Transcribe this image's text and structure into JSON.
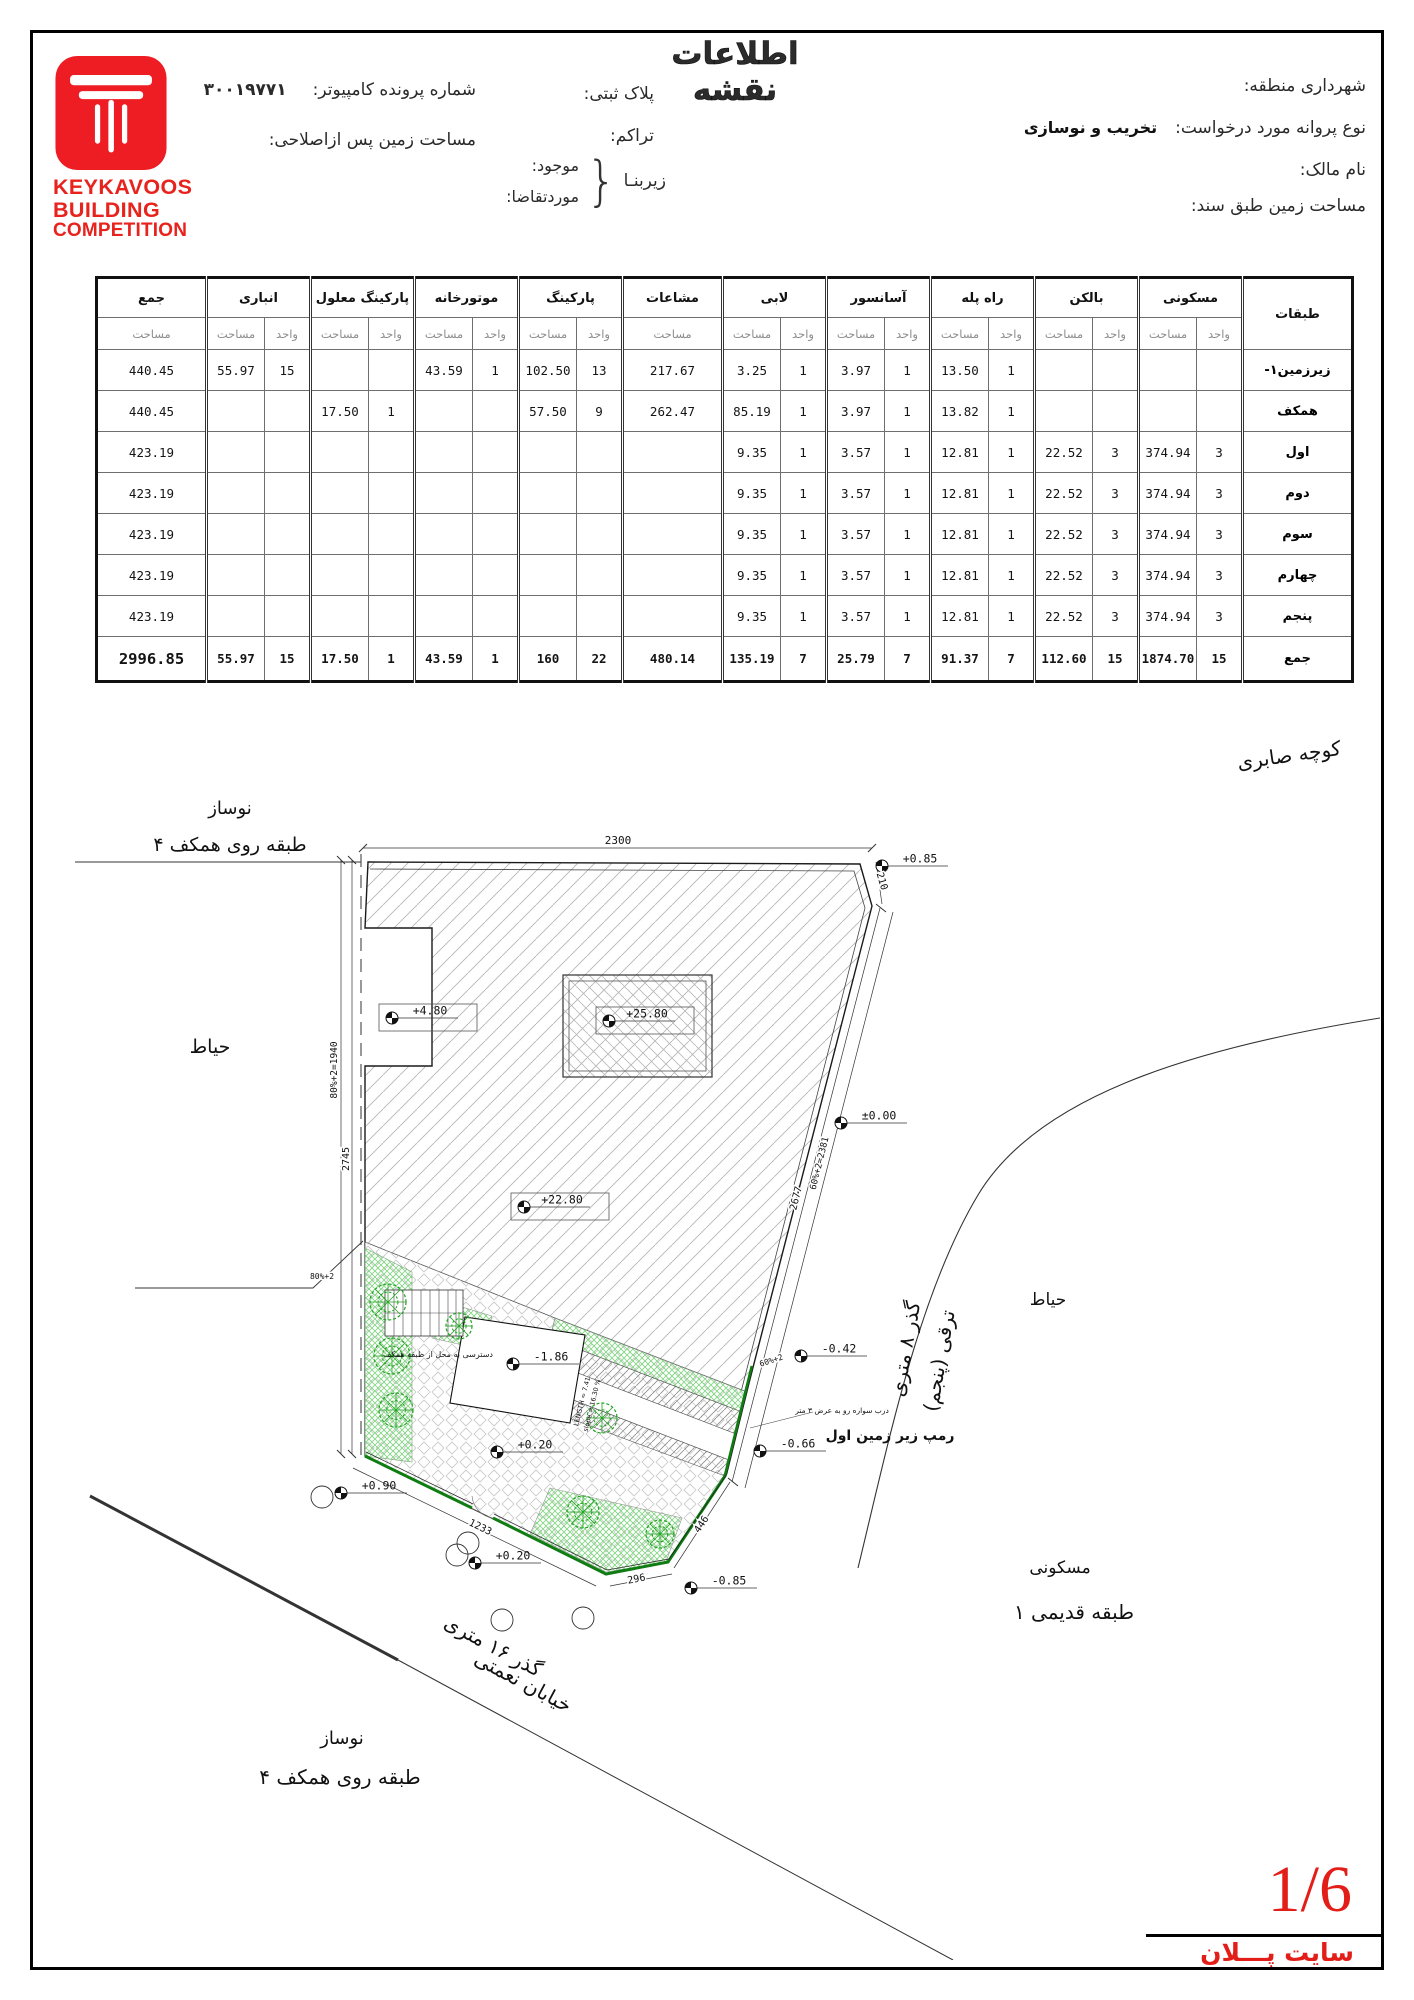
{
  "page": {
    "title": "اطلاعات نقشه",
    "sheet_number": "1/6",
    "sheet_name": "سایت پـــلان"
  },
  "logo": {
    "line1": "KEYKAVOOS",
    "line2": "BUILDING",
    "line3": "COMPETITION"
  },
  "header": {
    "municipality_label": "شهرداری منطقه:",
    "permit_type_label": "نوع پروانه مورد درخواست:",
    "permit_type_value": "تخریب و نوسازی",
    "owner_label": "نام مالک:",
    "deed_area_label": "مساحت زمین طبق سند:",
    "plate_label": "پلاک ثبتی:",
    "density_label": "تراکم:",
    "basement_label": "زیربنـا",
    "existing_label": "موجود:",
    "requested_label": "موردتقاضا:",
    "file_no_label": "شماره پرونده کامپیوتر:",
    "file_no_value": "۳۰۰۱۹۷۷۱",
    "corrected_area_label": "مساحت زمین پس ازاصلاحی:"
  },
  "table": {
    "row_header_title": "طبقات",
    "sub_area": "مساحت",
    "sub_unit": "واحد",
    "groups": [
      {
        "label": "مسکونی",
        "two": true
      },
      {
        "label": "بالکن",
        "two": true
      },
      {
        "label": "راه پله",
        "two": true
      },
      {
        "label": "آسانسور",
        "two": true
      },
      {
        "label": "لابی",
        "two": true
      },
      {
        "label": "مشاعات",
        "two": false,
        "w": 100
      },
      {
        "label": "پارکینگ",
        "two": true
      },
      {
        "label": "موتورخانه",
        "two": true
      },
      {
        "label": "پارکینگ معلول",
        "two": true
      },
      {
        "label": "انباری",
        "two": true
      },
      {
        "label": "جمع",
        "two": false,
        "w": 110
      }
    ],
    "rows": [
      {
        "label": "زیرزمین۱-",
        "v": [
          "",
          "",
          "",
          "",
          "1",
          "13.50",
          "1",
          "3.97",
          "1",
          "3.25",
          "217.67",
          "13",
          "102.50",
          "1",
          "43.59",
          "",
          "",
          "15",
          "55.97",
          "440.45"
        ]
      },
      {
        "label": "همکف",
        "v": [
          "",
          "",
          "",
          "",
          "1",
          "13.82",
          "1",
          "3.97",
          "1",
          "85.19",
          "262.47",
          "9",
          "57.50",
          "",
          "",
          "1",
          "17.50",
          "",
          "",
          "440.45"
        ]
      },
      {
        "label": "اول",
        "v": [
          "3",
          "374.94",
          "3",
          "22.52",
          "1",
          "12.81",
          "1",
          "3.57",
          "1",
          "9.35",
          "",
          "",
          "",
          "",
          "",
          "",
          "",
          "",
          "",
          "423.19"
        ]
      },
      {
        "label": "دوم",
        "v": [
          "3",
          "374.94",
          "3",
          "22.52",
          "1",
          "12.81",
          "1",
          "3.57",
          "1",
          "9.35",
          "",
          "",
          "",
          "",
          "",
          "",
          "",
          "",
          "",
          "423.19"
        ]
      },
      {
        "label": "سوم",
        "v": [
          "3",
          "374.94",
          "3",
          "22.52",
          "1",
          "12.81",
          "1",
          "3.57",
          "1",
          "9.35",
          "",
          "",
          "",
          "",
          "",
          "",
          "",
          "",
          "",
          "423.19"
        ]
      },
      {
        "label": "چهارم",
        "v": [
          "3",
          "374.94",
          "3",
          "22.52",
          "1",
          "12.81",
          "1",
          "3.57",
          "1",
          "9.35",
          "",
          "",
          "",
          "",
          "",
          "",
          "",
          "",
          "",
          "423.19"
        ]
      },
      {
        "label": "پنجم",
        "v": [
          "3",
          "374.94",
          "3",
          "22.52",
          "1",
          "12.81",
          "1",
          "3.57",
          "1",
          "9.35",
          "",
          "",
          "",
          "",
          "",
          "",
          "",
          "",
          "",
          "423.19"
        ]
      },
      {
        "label": "جمع",
        "v": [
          "15",
          "1874.70",
          "15",
          "112.60",
          "7",
          "91.37",
          "7",
          "25.79",
          "7",
          "135.19",
          "480.14",
          "22",
          "160",
          "1",
          "43.59",
          "1",
          "17.50",
          "15",
          "55.97",
          "2996.85"
        ]
      }
    ]
  },
  "site_plan": {
    "markers": [
      {
        "label": "+4.80",
        "x": 332,
        "y": 368,
        "boxed": true
      },
      {
        "label": "+25.80",
        "x": 549,
        "y": 371,
        "boxed": true
      },
      {
        "label": "+22.80",
        "x": 464,
        "y": 557,
        "boxed": true
      },
      {
        "label": "+0.85",
        "x": 822,
        "y": 216
      },
      {
        "label": "±0.00",
        "x": 781,
        "y": 473
      },
      {
        "label": "-0.42",
        "x": 741,
        "y": 706
      },
      {
        "label": "-0.66",
        "x": 700,
        "y": 801
      },
      {
        "label": "-0.85",
        "x": 631,
        "y": 938
      },
      {
        "label": "+0.90",
        "x": 281,
        "y": 843
      },
      {
        "label": "+0.20",
        "x": 437,
        "y": 802
      },
      {
        "label": "+0.20",
        "x": 415,
        "y": 913
      },
      {
        "label": "-1.86",
        "x": 453,
        "y": 714
      }
    ],
    "dims": [
      {
        "t": "2300",
        "x": 558,
        "y": 194,
        "r": 0,
        "s": 11
      },
      {
        "t": "210",
        "x": 819,
        "y": 232,
        "r": 74,
        "s": 10
      },
      {
        "t": "2677",
        "x": 739,
        "y": 549,
        "r": -76,
        "s": 10
      },
      {
        "t": "60%+2=2381",
        "x": 762,
        "y": 514,
        "r": -76,
        "s": 9
      },
      {
        "t": "80%+2=1940",
        "x": 277,
        "y": 420,
        "r": -90,
        "s": 9.5
      },
      {
        "t": "2745",
        "x": 289,
        "y": 509,
        "r": -90,
        "s": 10
      },
      {
        "t": "1233",
        "x": 419,
        "y": 880,
        "r": 26,
        "s": 10
      },
      {
        "t": "296",
        "x": 577,
        "y": 932,
        "r": -11,
        "s": 10
      },
      {
        "t": "446",
        "x": 644,
        "y": 876,
        "r": -56,
        "s": 10
      },
      {
        "t": "60%+2",
        "x": 712,
        "y": 713,
        "r": -18,
        "s": 8
      },
      {
        "t": "80%+2",
        "x": 262,
        "y": 629,
        "r": 0,
        "s": 8
      }
    ],
    "texts": [
      {
        "t": "کوچه صابری",
        "x": 1230,
        "y": 112,
        "r": -8,
        "s": 20
      },
      {
        "t": "نوساز",
        "x": 170,
        "y": 164,
        "r": 0,
        "s": 18
      },
      {
        "t": "۴ طبقه روی همکف",
        "x": 170,
        "y": 201,
        "r": 0,
        "s": 19
      },
      {
        "t": "حیاط",
        "x": 150,
        "y": 403,
        "r": 0,
        "s": 19
      },
      {
        "t": "حیاط",
        "x": 988,
        "y": 655,
        "r": 0,
        "s": 17
      },
      {
        "t": "گذر ۸ متری",
        "x": 852,
        "y": 700,
        "r": -80,
        "s": 20
      },
      {
        "t": "ترقی (پنجم)",
        "x": 886,
        "y": 712,
        "r": -80,
        "s": 20
      },
      {
        "t": "مسکونی",
        "x": 1000,
        "y": 923,
        "r": 0,
        "s": 17
      },
      {
        "t": "۱ طبقه قدیمی",
        "x": 1014,
        "y": 969,
        "r": 0,
        "s": 20
      },
      {
        "t": "گذر ۱۶ متری",
        "x": 430,
        "y": 1002,
        "r": 28,
        "s": 20
      },
      {
        "t": "خیابان نعمتی",
        "x": 460,
        "y": 1038,
        "r": 28,
        "s": 20
      },
      {
        "t": "نوساز",
        "x": 282,
        "y": 1094,
        "r": 0,
        "s": 18
      },
      {
        "t": "۴ طبقه روی همکف",
        "x": 280,
        "y": 1134,
        "r": 0,
        "s": 20
      },
      {
        "t": "رمپ زیر زمین اول",
        "x": 830,
        "y": 790,
        "r": 0,
        "s": 14,
        "b": true
      },
      {
        "t": "درب سواره رو به عرض ۳ متر",
        "x": 782,
        "y": 763,
        "r": 0,
        "s": 7.5
      },
      {
        "t": "دسترسی به محل از طبقه همکف",
        "x": 378,
        "y": 707,
        "r": 0,
        "s": 8
      },
      {
        "t": "LENGTH = 7.41",
        "x": 524,
        "y": 752,
        "r": -76,
        "s": 6.5
      },
      {
        "t": "slope = 16.30 %",
        "x": 534,
        "y": 756,
        "r": -76,
        "s": 6.5
      }
    ],
    "trees": [
      [
        328,
        652,
        18
      ],
      [
        332,
        706,
        18
      ],
      [
        336,
        760,
        17
      ],
      [
        399,
        676,
        13
      ],
      [
        542,
        768,
        15
      ],
      [
        523,
        862,
        16
      ],
      [
        600,
        884,
        14
      ]
    ],
    "trunks": [
      [
        262,
        847
      ],
      [
        408,
        893
      ],
      [
        397,
        905
      ],
      [
        442,
        970
      ],
      [
        523,
        968
      ]
    ]
  }
}
